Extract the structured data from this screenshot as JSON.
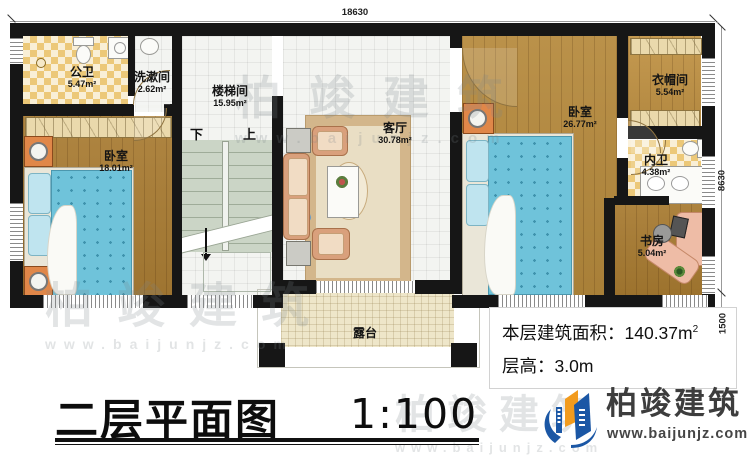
{
  "plan": {
    "title": "二层平面图",
    "scale": "1:100",
    "rooms": {
      "gongwei": {
        "name": "公卫",
        "area": "5.47m²"
      },
      "xishujian": {
        "name": "洗漱间",
        "area": "2.62m²"
      },
      "loutijian": {
        "name": "楼梯间",
        "area": "15.95m²"
      },
      "woshi_left": {
        "name": "卧室",
        "area": "18.01m²"
      },
      "keting": {
        "name": "客厅",
        "area": "30.78m²"
      },
      "woshi_right": {
        "name": "卧室",
        "area": "26.77m²"
      },
      "yimaojian": {
        "name": "衣帽间",
        "area": "5.54m²"
      },
      "neiwei": {
        "name": "内卫",
        "area": "4.38m²"
      },
      "shufang": {
        "name": "书房",
        "area": "5.04m²"
      },
      "lutai": {
        "name": "露台"
      }
    },
    "stairs": {
      "down": "下",
      "up": "上"
    },
    "dimensions": {
      "top": "18630",
      "right_main": "8630",
      "right_terrace": "1500"
    }
  },
  "info": {
    "area_label": "本层建筑面积：",
    "area_value": "140.37m",
    "area_sup": "2",
    "height_label": "层高：",
    "height_value": "3.0m"
  },
  "logo": {
    "name": "柏竣建筑",
    "url": "www.baijunjz.com"
  },
  "watermark": {
    "brand": "柏竣建筑",
    "url": "www.baijunjz.com"
  },
  "colors": {
    "wall": "#161616",
    "logo_blue": "#1b57a5",
    "logo_orange": "#f29b1d"
  }
}
